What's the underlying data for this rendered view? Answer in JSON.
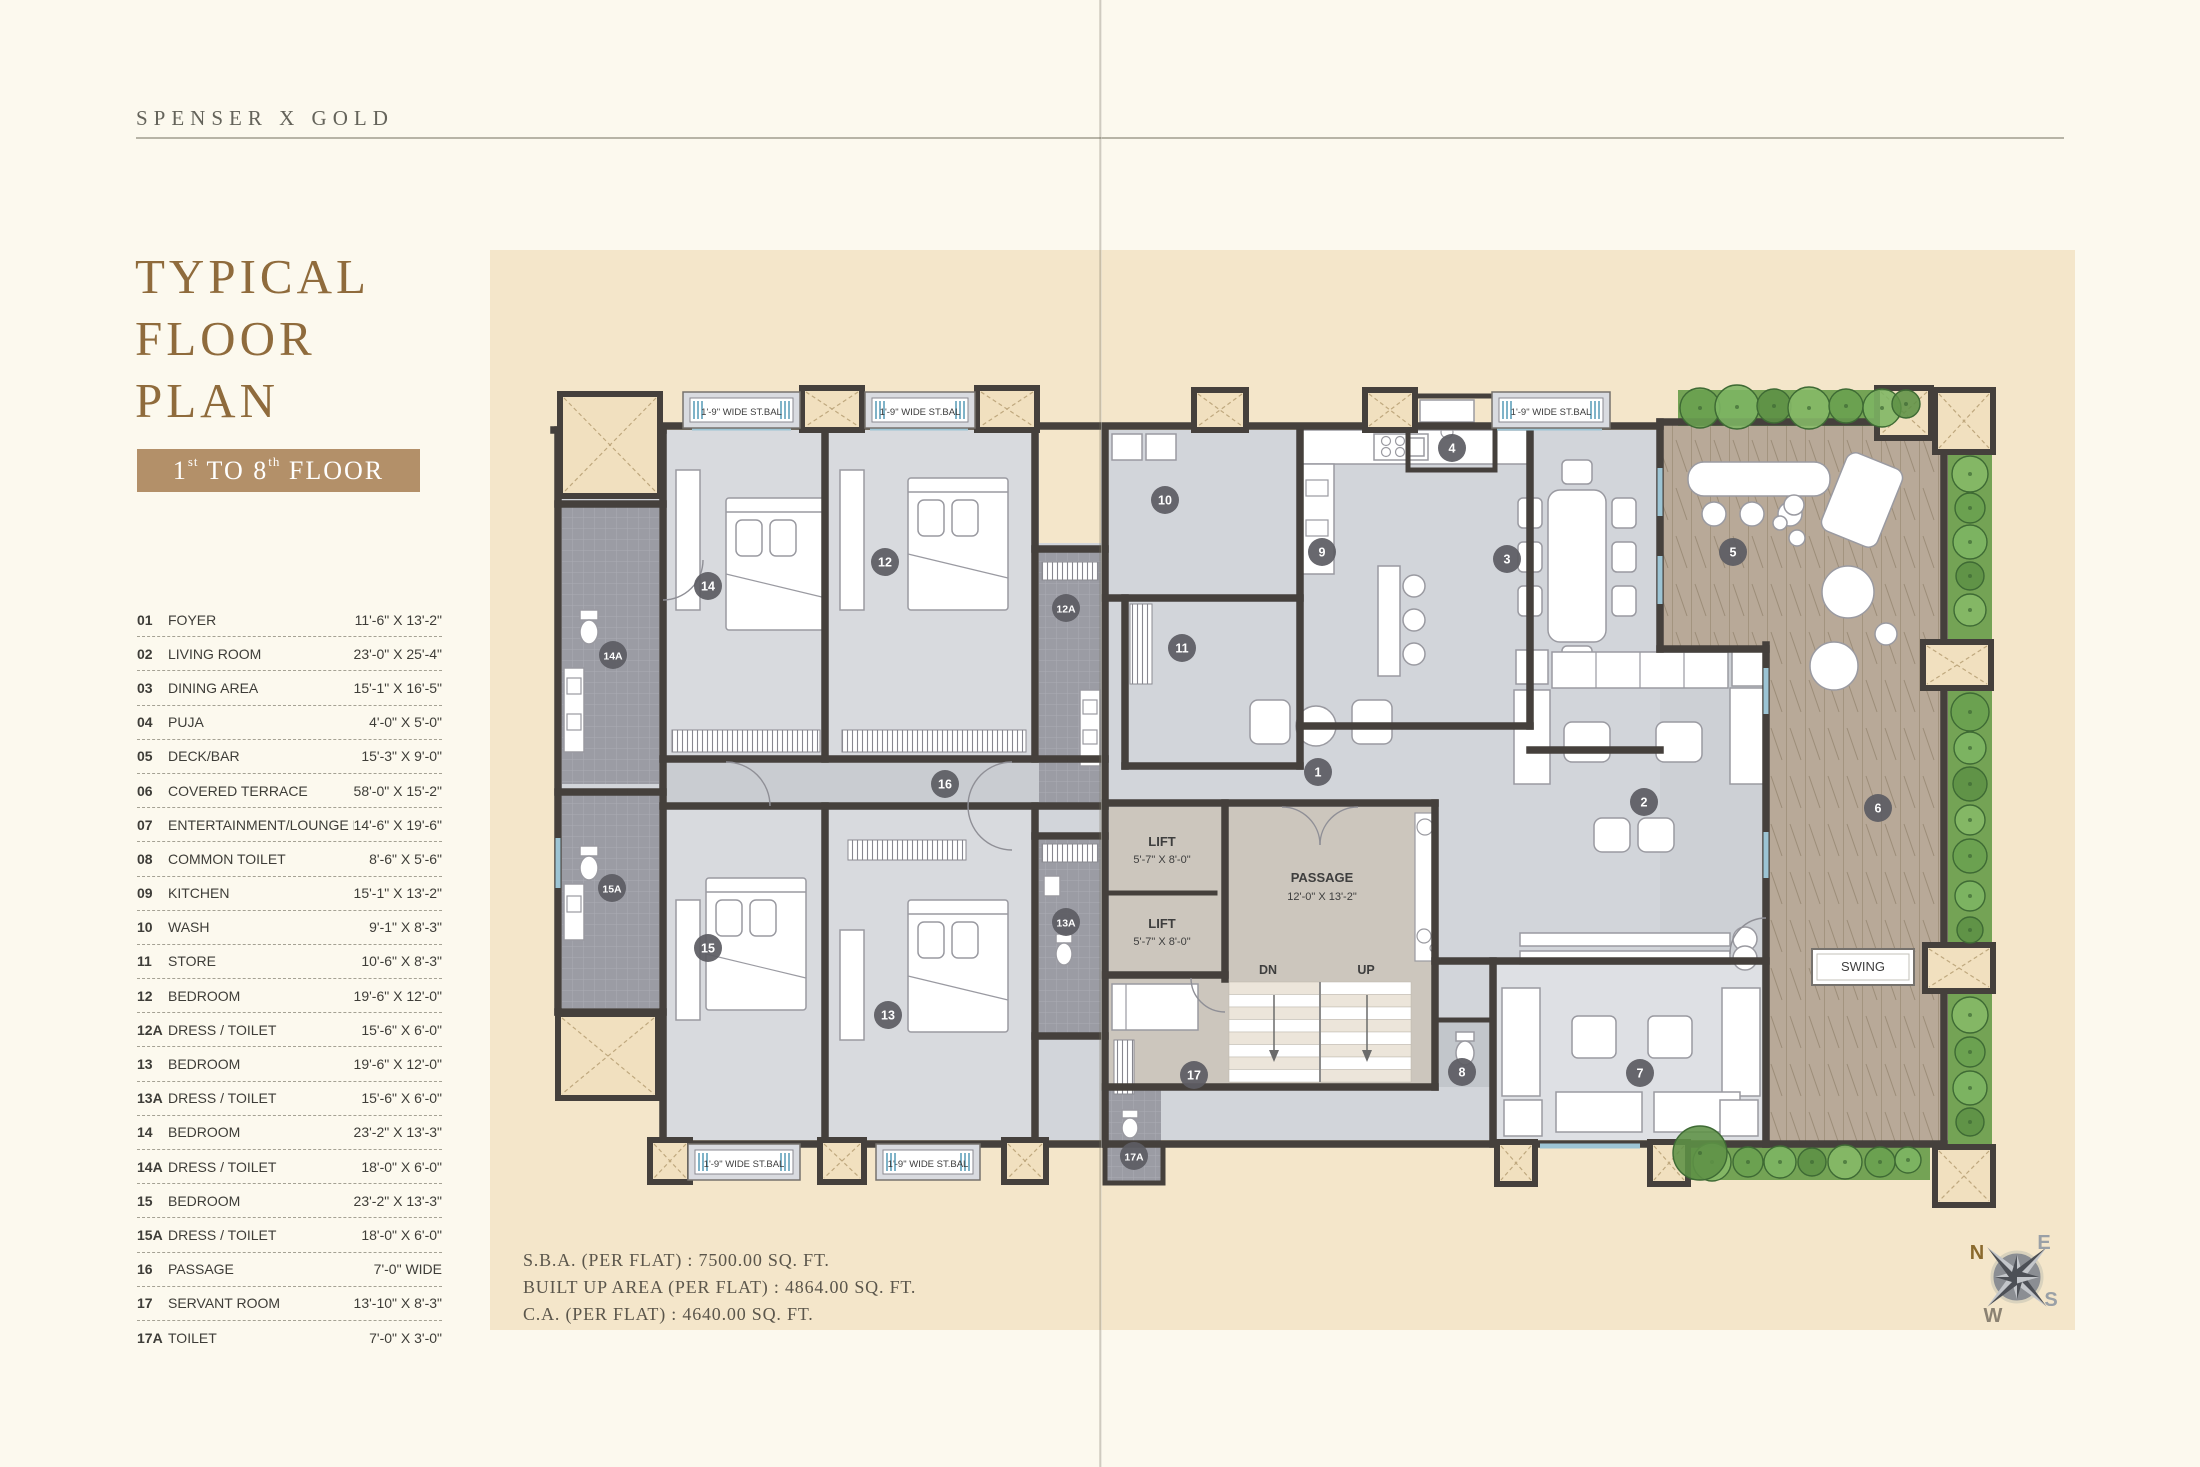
{
  "page": {
    "brand": "SPENSER X GOLD"
  },
  "title": {
    "lines": [
      "TYPICAL",
      "FLOOR",
      "PLAN"
    ]
  },
  "banner": {
    "n1": "1",
    "s1": "st",
    "mid": " TO 8",
    "s2": "th",
    "post": " FLOOR"
  },
  "legend": {
    "rows": [
      {
        "no": "01",
        "name": "FOYER",
        "dim": "11'-6\" X 13'-2\""
      },
      {
        "no": "02",
        "name": "LIVING ROOM",
        "dim": "23'-0\" X 25'-4\""
      },
      {
        "no": "03",
        "name": "DINING AREA",
        "dim": "15'-1\" X 16'-5\""
      },
      {
        "no": "04",
        "name": "PUJA",
        "dim": "4'-0\" X 5'-0\""
      },
      {
        "no": "05",
        "name": "DECK/BAR",
        "dim": "15'-3\" X 9'-0\""
      },
      {
        "no": "06",
        "name": "COVERED TERRACE",
        "dim": "58'-0\" X 15'-2\""
      },
      {
        "no": "07",
        "name": "ENTERTAINMENT/LOUNGE ROOM",
        "dim": "14'-6\" X 19'-6\""
      },
      {
        "no": "08",
        "name": "COMMON TOILET",
        "dim": "8'-6\" X 5'-6\""
      },
      {
        "no": "09",
        "name": "KITCHEN",
        "dim": "15'-1\" X 13'-2\""
      },
      {
        "no": "10",
        "name": "WASH",
        "dim": "9'-1\" X 8'-3\""
      },
      {
        "no": "11",
        "name": "STORE",
        "dim": "10'-6\" X 8'-3\""
      },
      {
        "no": "12",
        "name": "BEDROOM",
        "dim": "19'-6\" X 12'-0\""
      },
      {
        "no": "12A",
        "name": "DRESS / TOILET",
        "dim": "15'-6\" X 6'-0\""
      },
      {
        "no": "13",
        "name": "BEDROOM",
        "dim": "19'-6\" X 12'-0\""
      },
      {
        "no": "13A",
        "name": "DRESS / TOILET",
        "dim": "15'-6\" X 6'-0\""
      },
      {
        "no": "14",
        "name": "BEDROOM",
        "dim": "23'-2\" X 13'-3\""
      },
      {
        "no": "14A",
        "name": "DRESS / TOILET",
        "dim": "18'-0\" X 6'-0\""
      },
      {
        "no": "15",
        "name": "BEDROOM",
        "dim": "23'-2\" X 13'-3\""
      },
      {
        "no": "15A",
        "name": "DRESS / TOILET",
        "dim": "18'-0\" X 6'-0\""
      },
      {
        "no": "16",
        "name": "PASSAGE",
        "dim": "7'-0\" WIDE"
      },
      {
        "no": "17",
        "name": "SERVANT ROOM",
        "dim": "13'-10\" X 8'-3\""
      },
      {
        "no": "17A",
        "name": "TOILET",
        "dim": "7'-0\" X 3'-0\""
      }
    ]
  },
  "areas": {
    "lines": [
      "S.B.A. (PER FLAT) : 7500.00 SQ. FT.",
      "BUILT UP AREA (PER FLAT) : 4864.00 SQ. FT.",
      "C.A. (PER FLAT) : 4640.00 SQ. FT."
    ]
  },
  "plan": {
    "balcony_label": "1'-9\" WIDE ST.BAL",
    "lift": {
      "title": "LIFT",
      "dim": "5'-7\" X 8'-0\""
    },
    "passage": {
      "title": "PASSAGE",
      "dim": "12'-0\" X 13'-2\""
    },
    "stairs": {
      "down": "DN",
      "up": "UP"
    },
    "swing": "SWING",
    "markers": [
      {
        "label": "1",
        "x": 1318,
        "y": 772
      },
      {
        "label": "2",
        "x": 1644,
        "y": 802
      },
      {
        "label": "3",
        "x": 1507,
        "y": 559
      },
      {
        "label": "4",
        "x": 1452,
        "y": 448
      },
      {
        "label": "5",
        "x": 1733,
        "y": 552
      },
      {
        "label": "6",
        "x": 1878,
        "y": 808
      },
      {
        "label": "7",
        "x": 1640,
        "y": 1073
      },
      {
        "label": "8",
        "x": 1462,
        "y": 1072
      },
      {
        "label": "9",
        "x": 1322,
        "y": 552
      },
      {
        "label": "10",
        "x": 1165,
        "y": 500
      },
      {
        "label": "11",
        "x": 1182,
        "y": 648
      },
      {
        "label": "12",
        "x": 885,
        "y": 562
      },
      {
        "label": "12A",
        "x": 1066,
        "y": 608
      },
      {
        "label": "13",
        "x": 888,
        "y": 1015
      },
      {
        "label": "13A",
        "x": 1066,
        "y": 922
      },
      {
        "label": "14",
        "x": 708,
        "y": 586
      },
      {
        "label": "14A",
        "x": 613,
        "y": 655
      },
      {
        "label": "15",
        "x": 708,
        "y": 948
      },
      {
        "label": "15A",
        "x": 612,
        "y": 888
      },
      {
        "label": "16",
        "x": 945,
        "y": 784
      },
      {
        "label": "17",
        "x": 1194,
        "y": 1075
      },
      {
        "label": "17A",
        "x": 1134,
        "y": 1156
      }
    ]
  },
  "compass": {
    "n": "N",
    "e": "E",
    "s": "S",
    "w": "W"
  },
  "colors": {
    "accent": "#8f6b3c",
    "banner_bg": "#b39069",
    "page_bg": "#fcf9ee",
    "panel_bg": "#f4e6ca",
    "marker_bg": "#5d5d63",
    "wall": "#45403c",
    "deck": "#b8a998",
    "green": "#74a355",
    "window_blue": "#9cc4d4"
  }
}
